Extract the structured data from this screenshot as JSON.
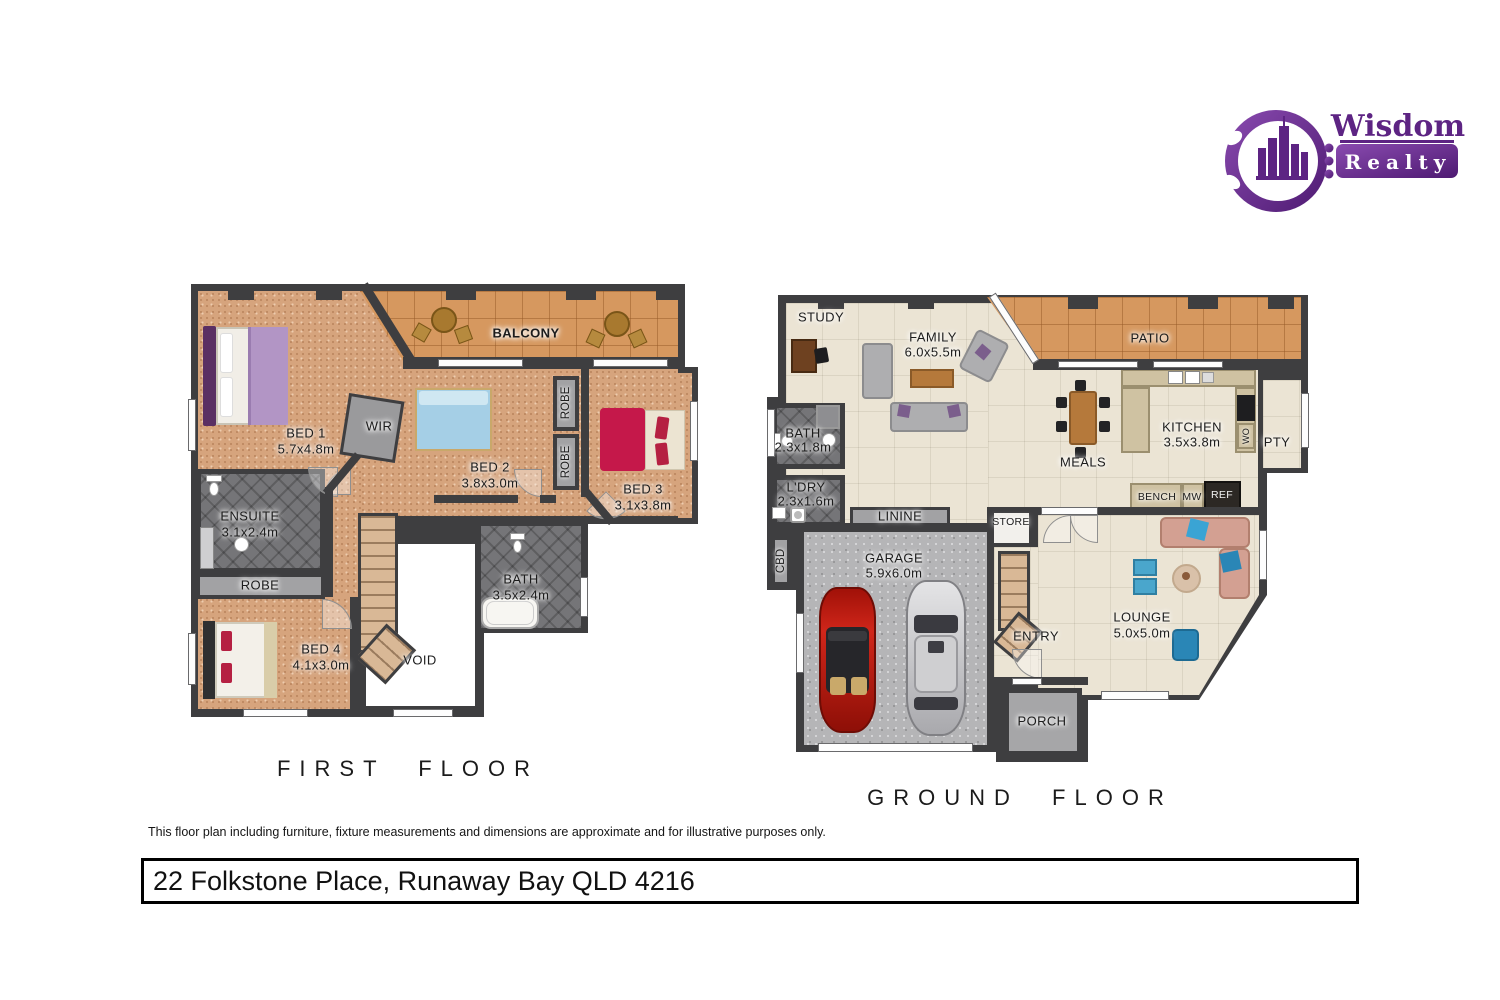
{
  "logo": {
    "brand_line1": "Wisdom",
    "brand_line2": "Realty"
  },
  "first_floor": {
    "title": "FIRST FLOOR",
    "balcony": "BALCONY",
    "bed1": {
      "name": "BED 1",
      "dims": "5.7x4.8m"
    },
    "wir": "WIR",
    "bed2": {
      "name": "BED 2",
      "dims": "3.8x3.0m"
    },
    "robe_upper": "ROBE",
    "robe_lower": "ROBE",
    "bed3": {
      "name": "BED 3",
      "dims": "3.1x3.8m"
    },
    "ensuite": {
      "name": "ENSUITE",
      "dims": "3.1x2.4m"
    },
    "robe": "ROBE",
    "bed4": {
      "name": "BED 4",
      "dims": "4.1x3.0m"
    },
    "void": "VOID",
    "bath": {
      "name": "BATH",
      "dims": "3.5x2.4m"
    }
  },
  "ground_floor": {
    "title": "GROUND FLOOR",
    "study": "STUDY",
    "family": {
      "name": "FAMILY",
      "dims": "6.0x5.5m"
    },
    "patio": "PATIO",
    "bath": {
      "name": "BATH",
      "dims": "2.3x1.8m"
    },
    "laundry": {
      "name": "L'DRY",
      "dims": "2.3x1.6m"
    },
    "linen": "LININE",
    "meals": "MEALS",
    "kitchen": {
      "name": "KITCHEN",
      "dims": "3.5x3.8m"
    },
    "pantry": "PTY",
    "wall_oven": "WO",
    "bench": "BENCH",
    "microwave": "MW",
    "fridge": "REF",
    "store": "STORE",
    "cupboard": "CBD",
    "garage": {
      "name": "GARAGE",
      "dims": "5.9x6.0m"
    },
    "entry": "ENTRY",
    "lounge": {
      "name": "LOUNGE",
      "dims": "5.0x5.0m"
    },
    "porch": "PORCH"
  },
  "footer": {
    "disclaimer": "This floor plan including furniture, fixture measurements and dimensions are approximate and for illustrative purposes only.",
    "address": "22 Folkstone Place, Runaway Bay QLD 4216"
  },
  "colors": {
    "brand_purple": "#5d2483",
    "wall": "#3e3e40",
    "carpet": "#d6a47d",
    "patio_tile": "#d6985f",
    "floor_cream": "#ebe4d4",
    "bath_tile": "#757578",
    "garage_gray": "#b5b5b7"
  }
}
